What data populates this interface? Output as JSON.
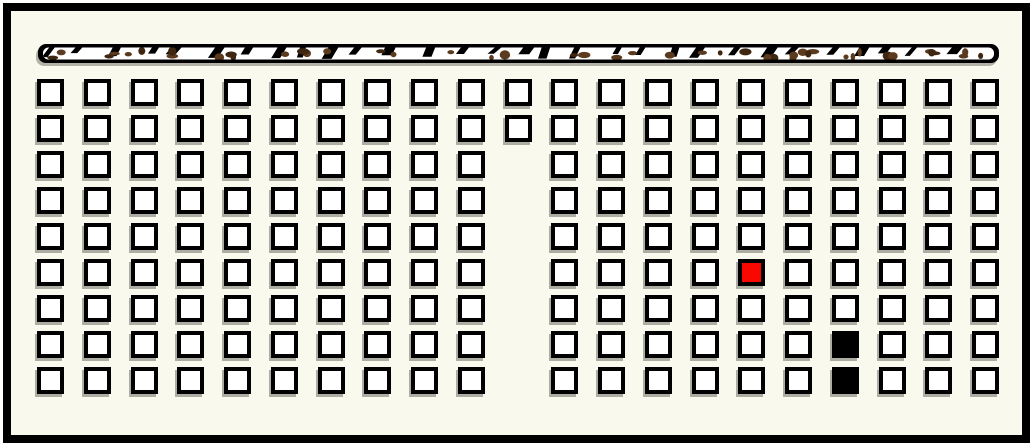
{
  "board": {
    "width": 1033,
    "height": 446,
    "frame_border_color": "#000000",
    "background_color": "#faf9ee"
  },
  "top_bar": {
    "x": 38,
    "y": 44,
    "width": 961,
    "height": 19,
    "fill": "#ffffff",
    "border_color": "#000000",
    "brown_speckle_color": "#5b3a1e",
    "brown_speckle_color_dark": "#3f2611",
    "black_mark_color": "#000000",
    "brown_speckle_count": 46,
    "black_mark_count": 30
  },
  "grid": {
    "columns": 21,
    "rows": 9,
    "origin_x": 37,
    "origin_y": 79,
    "pitch_x": 46.75,
    "pitch_y": 36,
    "cell_size": 27,
    "cell_fill": "#ffffff",
    "cell_border": "#000000",
    "red_fill": "#f80800",
    "black_fill": "#000000",
    "missing_cells": [
      [
        3,
        11
      ],
      [
        4,
        11
      ],
      [
        5,
        11
      ],
      [
        6,
        11
      ],
      [
        7,
        11
      ],
      [
        8,
        11
      ],
      [
        9,
        11
      ]
    ],
    "red_cells": [
      [
        6,
        16
      ]
    ],
    "black_cells": [
      [
        8,
        18
      ],
      [
        9,
        18
      ]
    ]
  }
}
